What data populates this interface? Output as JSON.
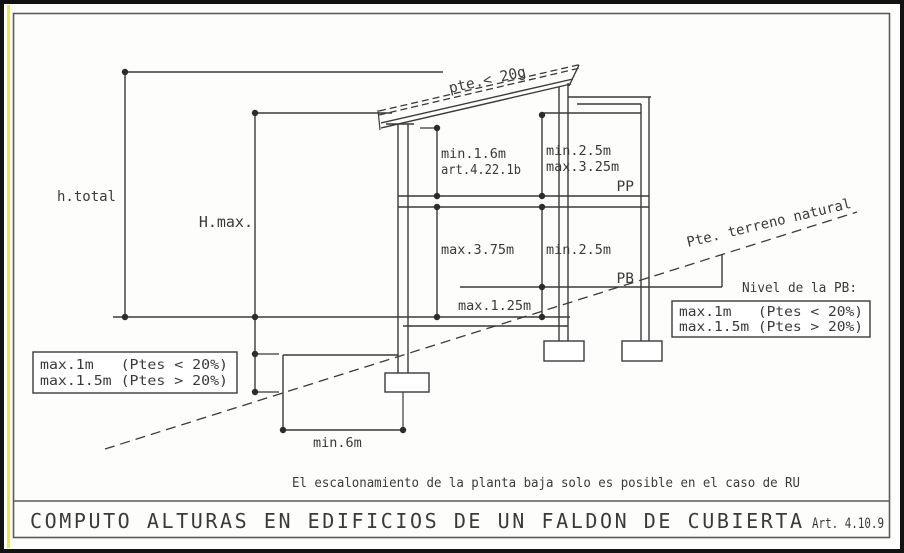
{
  "colors": {
    "line": "#3a3a3a",
    "accent_yellow": "#ece93c",
    "frame_black": "#121212",
    "inner_border_gray": "#5c5c5c"
  },
  "labels": {
    "h_total": "h.total",
    "h_max": "H.max.",
    "roof_slope": "pte.< 20g",
    "attic_height": "min.1.6m",
    "attic_article": "art.4.22.1b",
    "pp_min_height": "min.2.5m",
    "pp_max_height": "max.3.25m",
    "pp": "PP",
    "pb_max_height": "max.3.75m",
    "pb_min_height": "min.2.5m",
    "pb": "PB",
    "pb_step": "max.1.25m",
    "terrain_slope": "Pte. terreno natural",
    "pb_level_heading": "Nivel de la PB:",
    "min_width": "min.6m"
  },
  "boxes": {
    "step_left": {
      "line1": "max.1m   (Ptes < 20%)",
      "line2": "max.1.5m (Ptes > 20%)"
    },
    "pb_level": {
      "line1": "max.1m   (Ptes < 20%)",
      "line2": "max.1.5m (Ptes > 20%)"
    }
  },
  "note": "El escalonamiento de la planta baja solo es posible en el caso de RU",
  "title": {
    "main": "COMPUTO ALTURAS EN EDIFICIOS DE UN FALDON DE CUBIERTA",
    "article": "Art. 4.10.9"
  }
}
